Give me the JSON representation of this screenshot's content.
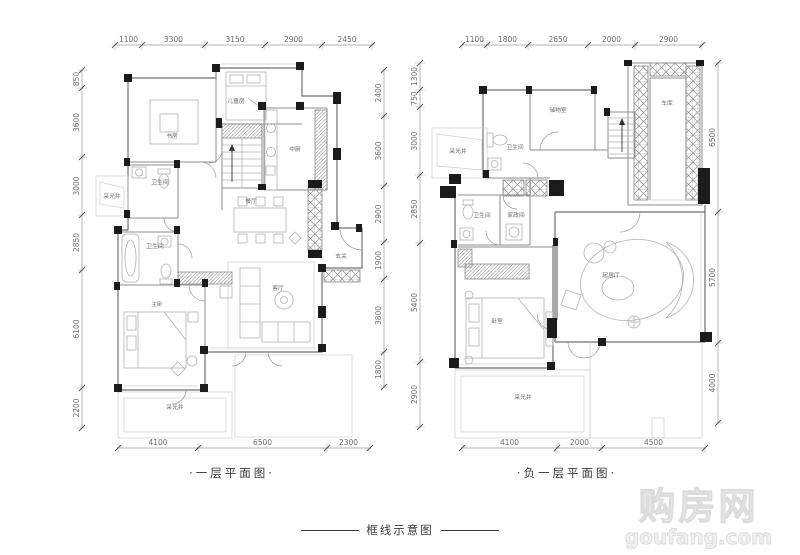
{
  "page": {
    "background": "#ffffff"
  },
  "footer": {
    "caption": "框线示意图"
  },
  "watermark": {
    "line1": "购房网",
    "line2": "goufang.com"
  },
  "plans": [
    {
      "id": "first-floor",
      "caption": "·一层平面图·",
      "rooms": [
        {
          "label": "书房",
          "x": 172,
          "y": 138
        },
        {
          "label": "儿童房",
          "x": 236,
          "y": 103
        },
        {
          "label": "中厨",
          "x": 295,
          "y": 151
        },
        {
          "label": "玄关",
          "x": 341,
          "y": 258
        },
        {
          "label": "卫生间",
          "x": 160,
          "y": 184
        },
        {
          "label": "采光井",
          "x": 112,
          "y": 198
        },
        {
          "label": "卫生间",
          "x": 155,
          "y": 248
        },
        {
          "label": "餐厅",
          "x": 251,
          "y": 203
        },
        {
          "label": "客厅",
          "x": 278,
          "y": 290
        },
        {
          "label": "主卧",
          "x": 157,
          "y": 306
        },
        {
          "label": "采光井",
          "x": 175,
          "y": 409
        }
      ],
      "dims": {
        "top": {
          "orientation": "h",
          "line": 45,
          "ticks": [
            115,
            142,
            205,
            265,
            322,
            372
          ],
          "labels": [
            "1100",
            "3300",
            "3150",
            "2900",
            "2450"
          ]
        },
        "left": {
          "orientation": "v",
          "line": 82,
          "ticks": [
            70,
            88,
            157,
            215,
            270,
            388,
            428
          ],
          "labels": [
            "850",
            "3600",
            "3000",
            "2850",
            "6100",
            "2200"
          ]
        },
        "right": {
          "orientation": "v",
          "line": 384,
          "ticks": [
            70,
            116,
            186,
            242,
            279,
            352,
            387
          ],
          "labels": [
            "2400",
            "3600",
            "2900",
            "1900",
            "3800",
            "1800"
          ]
        },
        "bottom": {
          "orientation": "h",
          "line": 448,
          "ticks": [
            118,
            198,
            327,
            370
          ],
          "labels": [
            "4100",
            "6500",
            "2300"
          ]
        }
      }
    },
    {
      "id": "basement-floor",
      "caption": "·负一层平面图·",
      "rooms": [
        {
          "label": "采光井",
          "x": 458,
          "y": 153
        },
        {
          "label": "卫生间",
          "x": 515,
          "y": 149
        },
        {
          "label": "储物室",
          "x": 558,
          "y": 112
        },
        {
          "label": "车库",
          "x": 667,
          "y": 105
        },
        {
          "label": "卫生间",
          "x": 482,
          "y": 217
        },
        {
          "label": "家政间",
          "x": 516,
          "y": 217
        },
        {
          "label": "卧室",
          "x": 497,
          "y": 323
        },
        {
          "label": "起居厅",
          "x": 611,
          "y": 277
        },
        {
          "label": "采光井",
          "x": 523,
          "y": 399
        }
      ],
      "dims": {
        "top": {
          "orientation": "h",
          "line": 45,
          "ticks": [
            462,
            487,
            528,
            588,
            635,
            702
          ],
          "labels": [
            "1100",
            "1800",
            "2650",
            "2000",
            "2900"
          ]
        },
        "left": {
          "orientation": "v",
          "line": 420,
          "ticks": [
            63,
            90,
            107,
            175,
            243,
            362,
            427
          ],
          "labels": [
            "1300",
            "750",
            "3000",
            "2850",
            "5400",
            "2900"
          ]
        },
        "right": {
          "orientation": "v",
          "line": 718,
          "ticks": [
            63,
            212,
            343,
            423
          ],
          "labels": [
            "6500",
            "5700",
            "4000"
          ]
        },
        "bottom": {
          "orientation": "h",
          "line": 448,
          "ticks": [
            462,
            557,
            602,
            705
          ],
          "labels": [
            "4100",
            "2000",
            "4500"
          ]
        }
      }
    }
  ]
}
